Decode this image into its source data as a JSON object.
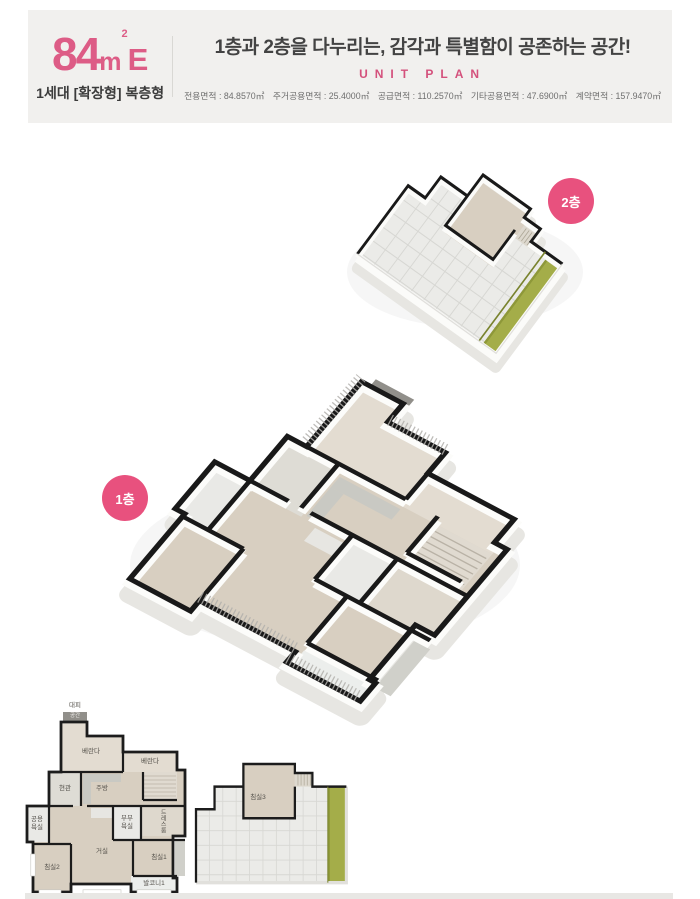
{
  "header": {
    "unit_size": "84",
    "unit_m": "m",
    "unit_sup": "2",
    "unit_type": "E",
    "unit_desc": "1세대 [확장형] 복층형",
    "headline": "1층과 2층을 다누리는, 감각과 특별함이 공존하는 공간!",
    "subtitle": "UNIT PLAN",
    "areas": [
      {
        "text": "전용면적 : 84.8570㎡"
      },
      {
        "text": "주거공용면적 : 25.4000㎡"
      },
      {
        "text": "공급면적 : 110.2570㎡"
      },
      {
        "text": "기타공용면적 : 47.6900㎡"
      },
      {
        "text": "계약면적 : 157.9470㎡"
      }
    ]
  },
  "badges": {
    "second_floor": "2층",
    "first_floor": "1층"
  },
  "floor1_rooms": {
    "evac_top": "대피",
    "evac_box": "공간",
    "veranda_left": "베란다",
    "veranda_right": "베란다",
    "kitchen": "주방",
    "entrance": "현관",
    "bath_common": "공용욕실",
    "bath_master": "부부욕실",
    "dress_room": "드레스룸",
    "bedroom1": "침실1",
    "bedroom2": "침실2",
    "living_room": "거실",
    "balcony1": "발코니1"
  },
  "floor2_rooms": {
    "bedroom3": "침실3"
  },
  "colors": {
    "accent_pink": "#e8517e",
    "headline_gray": "#434343",
    "header_bg": "#f1f0ee",
    "terrace_green": "#a4ad49",
    "wall_black": "#191919",
    "floor_wood": "#d8cfc1"
  }
}
